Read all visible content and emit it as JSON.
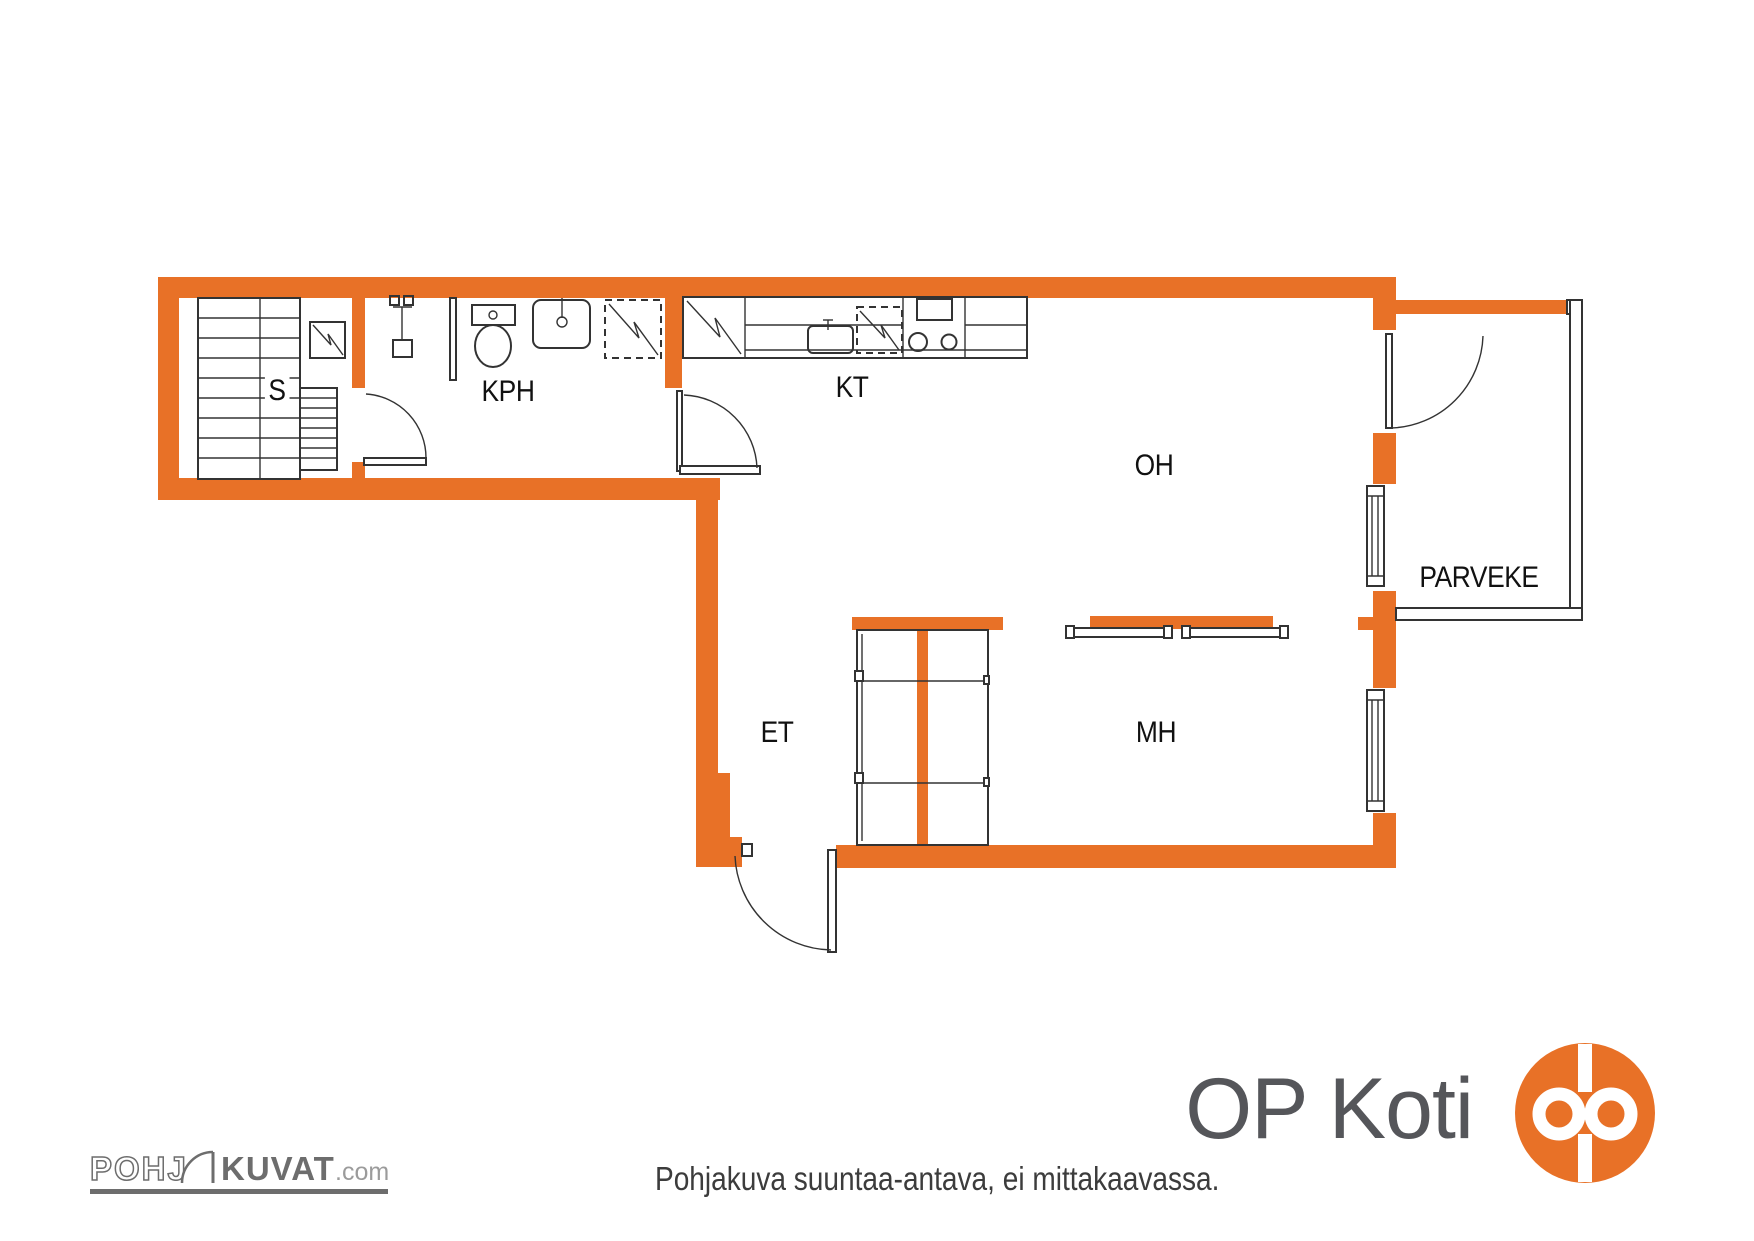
{
  "colors": {
    "wall": "#E87127",
    "line": "#333333",
    "label": "#111111",
    "footer_text": "#3c3c3c",
    "logo_gray": "#6d6d6d",
    "logo_light_gray": "#9b9b9b",
    "op_gray": "#55565a",
    "op_orange": "#E87127"
  },
  "rooms": [
    {
      "id": "sauna",
      "label": "S"
    },
    {
      "id": "bathroom",
      "label": "KPH"
    },
    {
      "id": "kitchen",
      "label": "KT"
    },
    {
      "id": "living-room",
      "label": "OH"
    },
    {
      "id": "balcony",
      "label": "PARVEKE"
    },
    {
      "id": "entry",
      "label": "ET"
    },
    {
      "id": "bedroom",
      "label": "MH"
    }
  ],
  "footer": {
    "disclaimer": "Pohjakuva suuntaa-antava, ei mittakaavassa."
  },
  "branding": {
    "pohjakuvat": {
      "outline_text": "POHJ",
      "bold_text": "KUVAT",
      "suffix": ".com"
    },
    "op_koti": {
      "text": "OP Koti"
    }
  }
}
